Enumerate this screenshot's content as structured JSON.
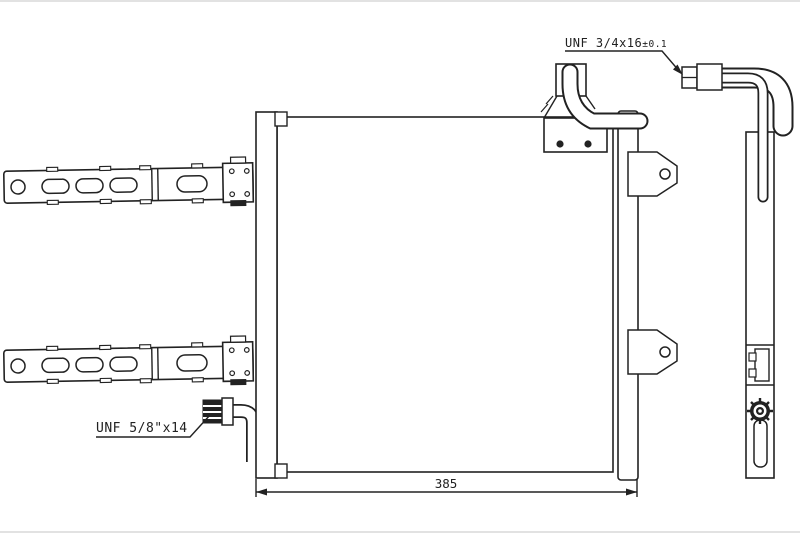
{
  "drawing": {
    "labels": {
      "top_fitting_spec": "UNF 3/4x16",
      "top_fitting_tolerance": "±0.1",
      "bottom_fitting_spec": "UNF 5/8\"x14"
    },
    "dimensions": {
      "core_height_mm": "362",
      "core_width_mm": "385"
    },
    "watermark": {
      "line1": "POLOVNI",
      "line2": "AUTOMOBILI"
    },
    "colors": {
      "line": "#222222",
      "watermark": "#edece9",
      "page_edge": "#e2e2e2",
      "background": "#ffffff"
    }
  }
}
